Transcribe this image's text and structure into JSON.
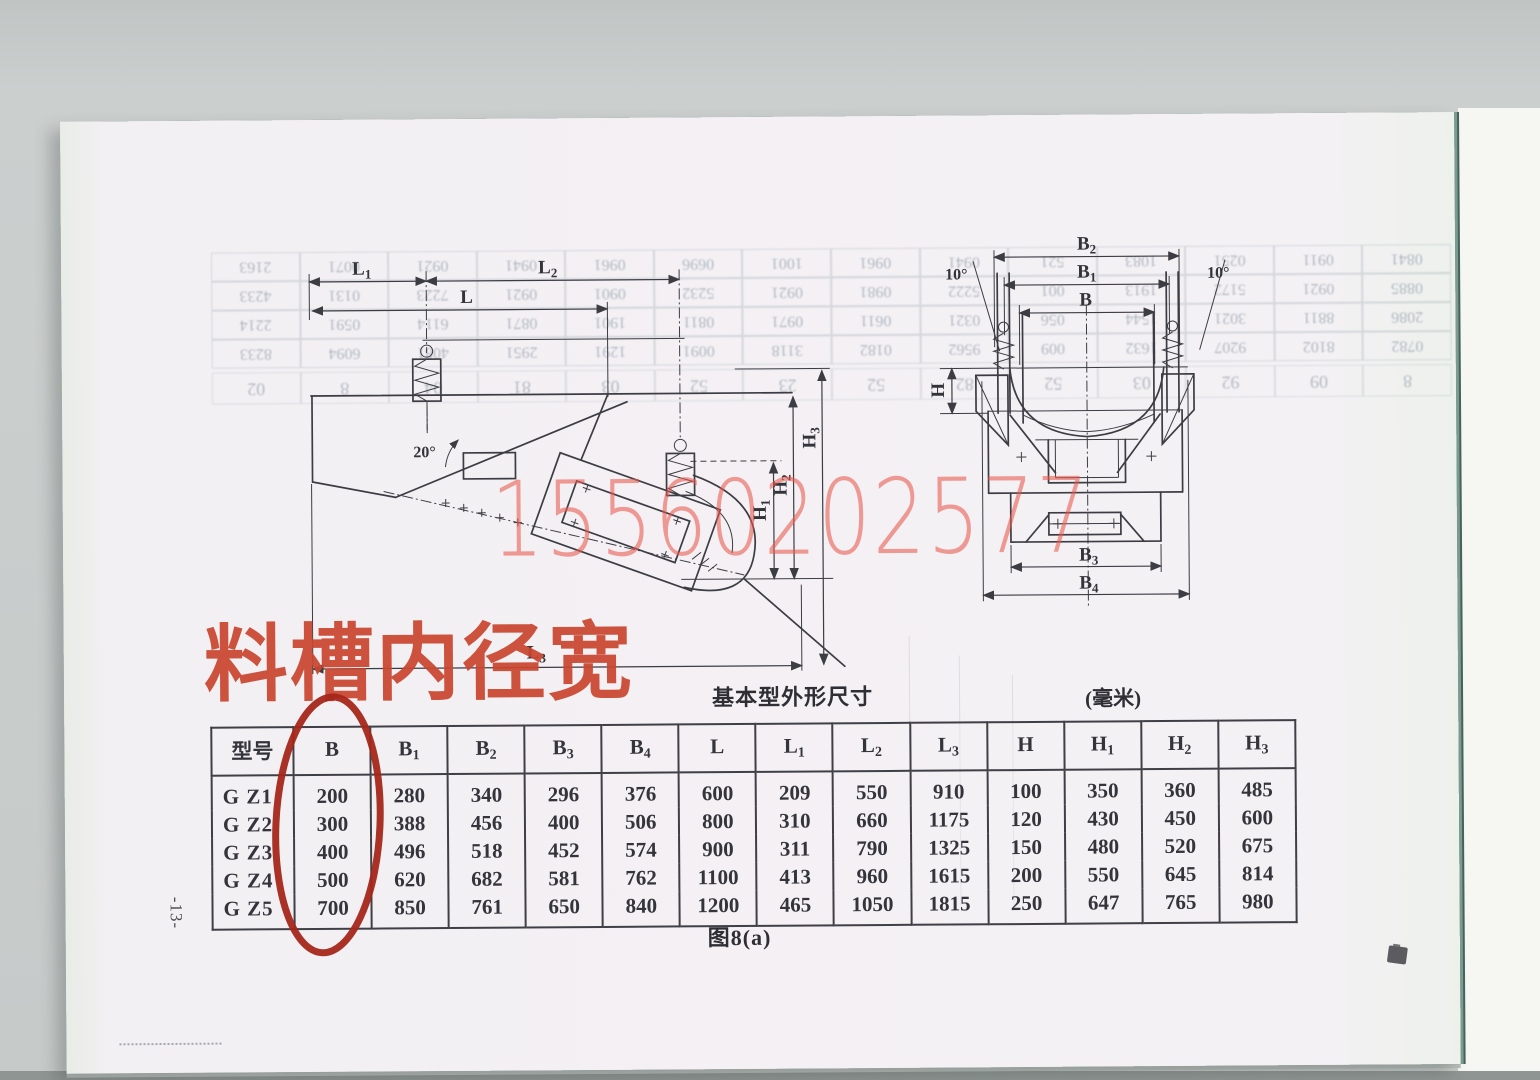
{
  "page": {
    "watermark": "15560202577",
    "red_annotation": "料槽内径宽",
    "figure_caption": "图8(a)",
    "page_number": "-13-"
  },
  "colors": {
    "annotation_red": "#c8462f",
    "circle_red": "#a5261a",
    "watermark_red": "#eb5850",
    "ink": "#3c3c43",
    "paper": "#f4f1f4",
    "edge_teal": "#44645b"
  },
  "drawings": {
    "side_view": {
      "angle": "20°",
      "labels": {
        "L1": {
          "base": "L",
          "sub": "1"
        },
        "L2": {
          "base": "L",
          "sub": "2"
        },
        "L": {
          "base": "L",
          "sub": ""
        },
        "L3": {
          "base": "L",
          "sub": "3"
        },
        "H1": {
          "base": "H",
          "sub": "1"
        },
        "H2": {
          "base": "H",
          "sub": "2"
        },
        "H3": {
          "base": "H",
          "sub": "3"
        }
      }
    },
    "front_view": {
      "angle_left": "10°",
      "angle_right": "10°",
      "labels": {
        "B2": {
          "base": "B",
          "sub": "2"
        },
        "B1": {
          "base": "B",
          "sub": "1"
        },
        "B": {
          "base": "B",
          "sub": ""
        },
        "B3": {
          "base": "B",
          "sub": "3"
        },
        "B4": {
          "base": "B",
          "sub": "4"
        },
        "H": {
          "base": "H",
          "sub": ""
        }
      }
    }
  },
  "table": {
    "title": "基本型外形尺寸",
    "unit": "(毫米)",
    "columns": [
      {
        "base": "型号",
        "sub": ""
      },
      {
        "base": "B",
        "sub": ""
      },
      {
        "base": "B",
        "sub": "1"
      },
      {
        "base": "B",
        "sub": "2"
      },
      {
        "base": "B",
        "sub": "3"
      },
      {
        "base": "B",
        "sub": "4"
      },
      {
        "base": "L",
        "sub": ""
      },
      {
        "base": "L",
        "sub": "1"
      },
      {
        "base": "L",
        "sub": "2"
      },
      {
        "base": "L",
        "sub": "3"
      },
      {
        "base": "H",
        "sub": ""
      },
      {
        "base": "H",
        "sub": "1"
      },
      {
        "base": "H",
        "sub": "2"
      },
      {
        "base": "H",
        "sub": "3"
      }
    ],
    "rows": [
      [
        "G Z1",
        "200",
        "280",
        "340",
        "296",
        "376",
        "600",
        "209",
        "550",
        "910",
        "100",
        "350",
        "360",
        "485"
      ],
      [
        "G Z2",
        "300",
        "388",
        "456",
        "400",
        "506",
        "800",
        "310",
        "660",
        "1175",
        "120",
        "430",
        "450",
        "600"
      ],
      [
        "G Z3",
        "400",
        "496",
        "518",
        "452",
        "574",
        "900",
        "311",
        "790",
        "1325",
        "150",
        "480",
        "520",
        "675"
      ],
      [
        "G Z4",
        "500",
        "620",
        "682",
        "581",
        "762",
        "1100",
        "413",
        "960",
        "1615",
        "200",
        "550",
        "645",
        "814"
      ],
      [
        "G Z5",
        "700",
        "850",
        "761",
        "650",
        "840",
        "1200",
        "465",
        "1050",
        "1815",
        "250",
        "647",
        "765",
        "980"
      ]
    ]
  },
  "bleedthrough": {
    "rows": [
      [
        "0782",
        "8102",
        "9207",
        "1632",
        "009",
        "9562",
        "0182",
        "3118",
        "0091",
        "1291",
        "2951",
        "4081",
        "6094",
        "8233"
      ],
      [
        "2086",
        "8811",
        "3021",
        "1544",
        "056",
        "0321",
        "0611",
        "0971",
        "0811",
        "1901",
        "0871",
        "6114",
        "0591",
        "2214"
      ],
      [
        "0885",
        "0921",
        "5172",
        "1913",
        "001",
        "5222",
        "0981",
        "0921",
        "5232",
        "0901",
        "0921",
        "7223",
        "0131",
        "4233"
      ],
      [
        "0841",
        "0911",
        "0251",
        "1083",
        "521",
        "0941",
        "0961",
        "1001",
        "0696",
        "0961",
        "0941",
        "0921",
        "0071",
        "2163"
      ]
    ],
    "row2": [
      "8",
      "09",
      "92",
      "03",
      "52",
      "82",
      "52",
      "23",
      "52",
      "03",
      "81",
      "04",
      "8",
      "02"
    ]
  }
}
